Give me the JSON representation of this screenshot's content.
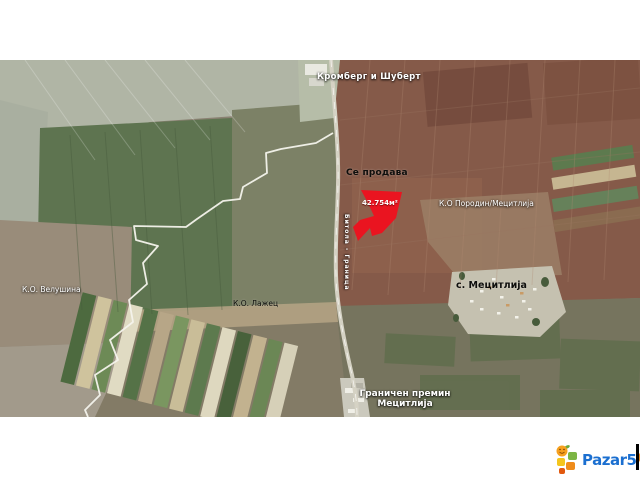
{
  "map": {
    "labels": {
      "company": "Кромберг и Шуберт",
      "sale_status": "Се продава",
      "parcel_area": "42.754м²",
      "cadastre_right": "К.О Породин/Мецитлија",
      "village": "с. Мецитлија",
      "cadastre_left": "К.О. Велушина",
      "cadastre_center": "К.О. Лажец",
      "border_crossing_line1": "Граничен премин",
      "border_crossing_line2": "Мецитлија",
      "road": "Битола - Граница"
    },
    "parcel_color": "#ea1420"
  },
  "branding": {
    "name": "Pazar5",
    "tld": ".mk"
  }
}
